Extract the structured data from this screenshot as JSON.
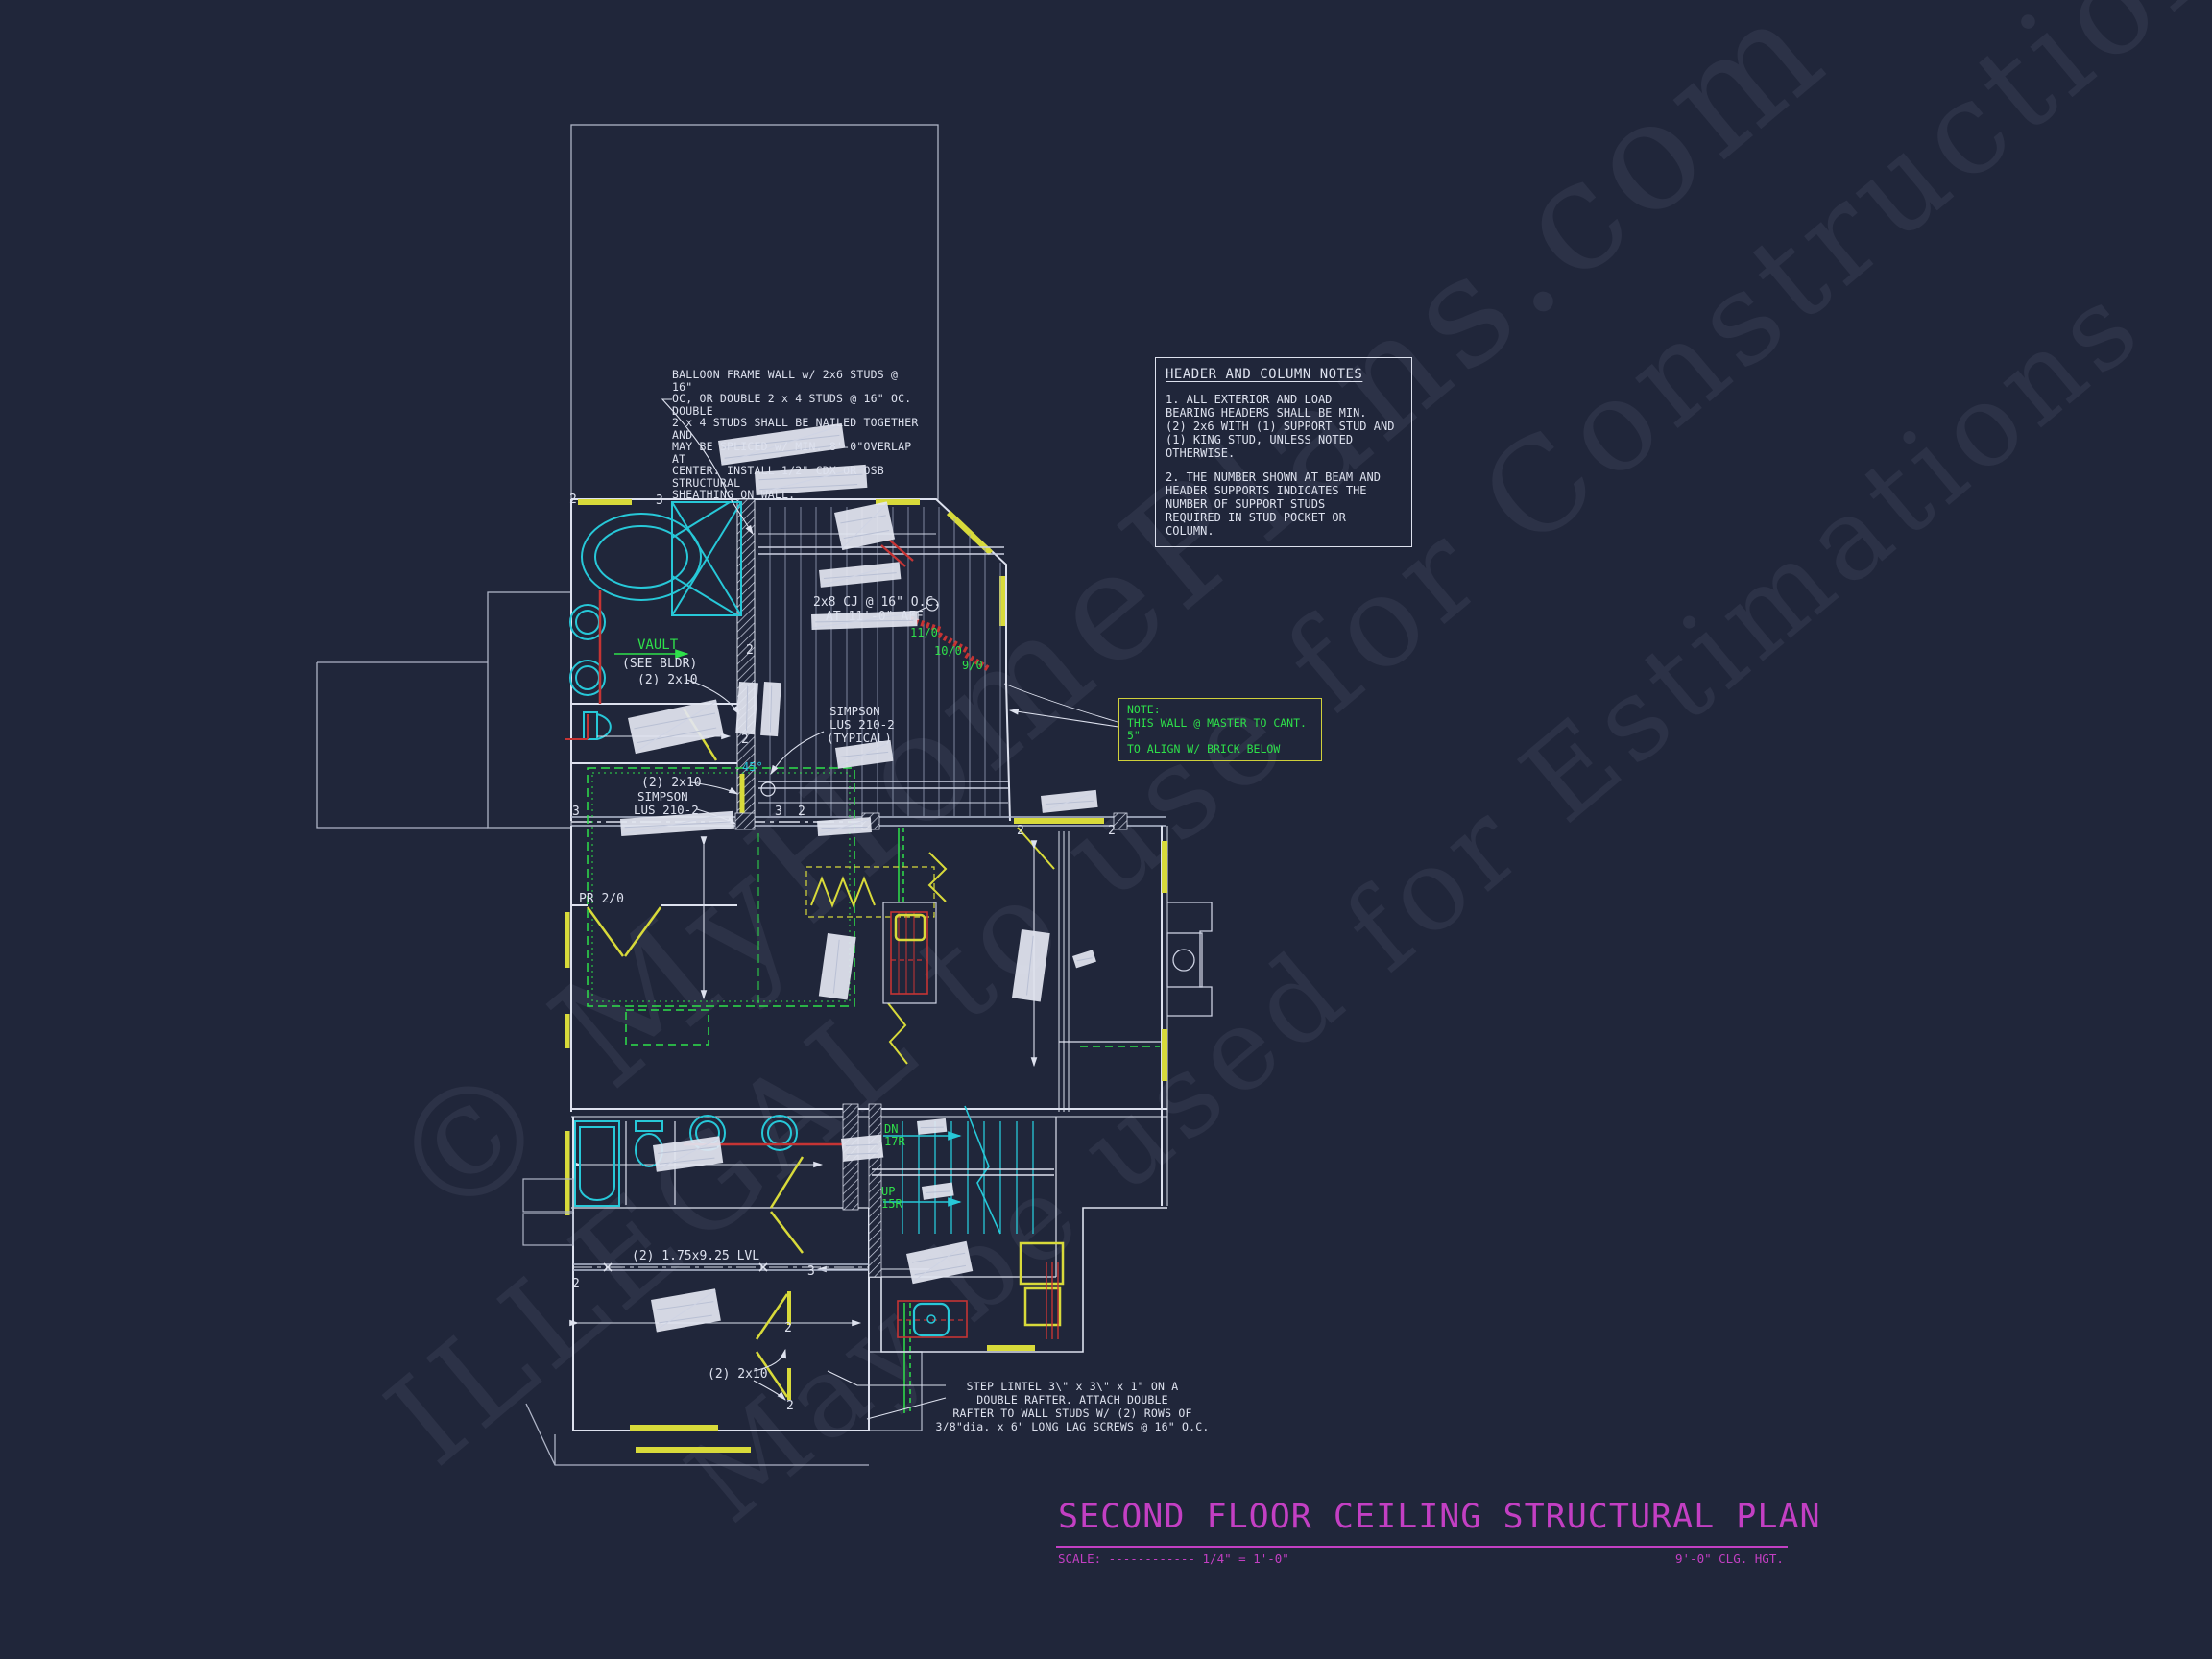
{
  "watermarks": {
    "line1": "© MyHomePlans.com",
    "line2": "ILLEGAL to use for Construction",
    "line3": "May be used for Estimations"
  },
  "notes": {
    "balloon": "BALLOON FRAME WALL w/ 2x6 STUDS @ 16\"\nOC, OR DOUBLE 2 x 4 STUDS @ 16\" OC. DOUBLE\n2 x 4 STUDS SHALL BE NAILED TOGETHER AND\nMAY BE SPLICED w/ MIN. 8'-0\"OVERLAP AT\nCENTER. INSTALL 1/2\" CDX OR OSB STRUCTURAL\nSHEATHING ON WALL.",
    "header_title": "HEADER AND COLUMN NOTES",
    "header_note1": "1. ALL EXTERIOR AND LOAD\nBEARING HEADERS SHALL BE MIN.\n(2) 2x6 WITH (1) SUPPORT STUD AND\n(1) KING STUD, UNLESS NOTED\nOTHERWISE.",
    "header_note2": "2. THE NUMBER SHOWN AT BEAM AND\nHEADER SUPPORTS INDICATES THE\nNUMBER OF SUPPORT STUDS\nREQUIRED IN STUD POCKET OR\nCOLUMN.",
    "cant_note": "NOTE:\nTHIS WALL @ MASTER TO CANT. 5\"\nTO ALIGN W/ BRICK BELOW",
    "step_lintel": "STEP LINTEL 3\\\" x 3\\\" x 1\" ON A\nDOUBLE RAFTER.  ATTACH DOUBLE\nRAFTER TO WALL STUDS W/ (2) ROWS OF\n3/8\"dia. x 6\" LONG LAG SCREWS @ 16\" O.C."
  },
  "labels": {
    "vault": "VAULT",
    "see_bldr": "(SEE BLDR)",
    "two_2x10": "(2) 2x10",
    "cj": "2x8 CJ @ 16\" O.C.",
    "cj_aff": "AT 11'-0\" AFF",
    "simpson": "SIMPSON",
    "lus": "LUS 210-2",
    "typical": "(TYPICAL)",
    "pr": "PR 2/0",
    "lvl": "(2) 1.75x9.25 LVL",
    "dn": "DN",
    "dn_risers": "17R",
    "up": "UP",
    "up_risers": "15R",
    "h11": "11/0",
    "h10": "10/0",
    "h9": "9/0",
    "angle": "45°"
  },
  "markers": {
    "two": "2",
    "three": "3"
  },
  "title_block": {
    "title": "SECOND FLOOR CEILING STRUCTURAL PLAN",
    "scale": "SCALE: ------------ 1/4\" = 1'-0\"",
    "ceiling_height": "9'-0\" CLG. HGT."
  },
  "colors": {
    "background": "#20263a",
    "cad_white": "#dde1ee",
    "window_yellow": "#d8da3a",
    "fixture_cyan": "#27c8d8",
    "below_green": "#2ee04a",
    "accent_red": "#c63434",
    "title_magenta": "#c33fc3"
  }
}
